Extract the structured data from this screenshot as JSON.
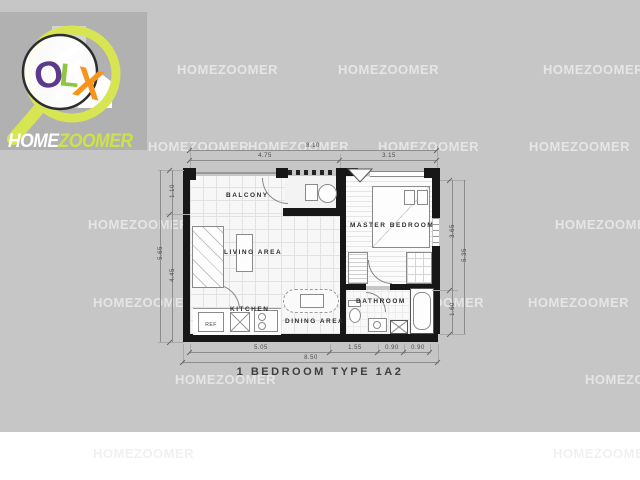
{
  "logo": {
    "o": "O",
    "l": "L",
    "x": "X",
    "home": "HOME",
    "zoomer": "ZOOMER",
    "colors": {
      "o": "#5b3a8c",
      "l": "#8dc63f",
      "x": "#f7941e",
      "ring": "#d8e552",
      "zoomer": "#cde24a"
    }
  },
  "watermark": {
    "text": "HOMEZOOMER"
  },
  "plan": {
    "title": "1 BEDROOM TYPE 1A2",
    "rooms": {
      "balcony": "BALCONY",
      "living": "LIVING AREA",
      "master": "MASTER BEDROOM",
      "kitchen": "KITCHEN",
      "dining": "DINING AREA",
      "bathroom": "BATHROOM"
    },
    "appliances": {
      "ref": "REF"
    },
    "dims": {
      "top_total": "8.10",
      "top_left": "4.75",
      "top_right": "3.15",
      "bottom_s1": "5.05",
      "bottom_s2": "1.55",
      "bottom_s3": "0.90",
      "bottom_s4": "0.90",
      "bottom_total": "8.50",
      "left_upper": "1.10",
      "left_lower": "4.45",
      "left_total": "5.65",
      "right_upper": "3.65",
      "right_lower": "1.60",
      "right_total": "5.35"
    }
  }
}
